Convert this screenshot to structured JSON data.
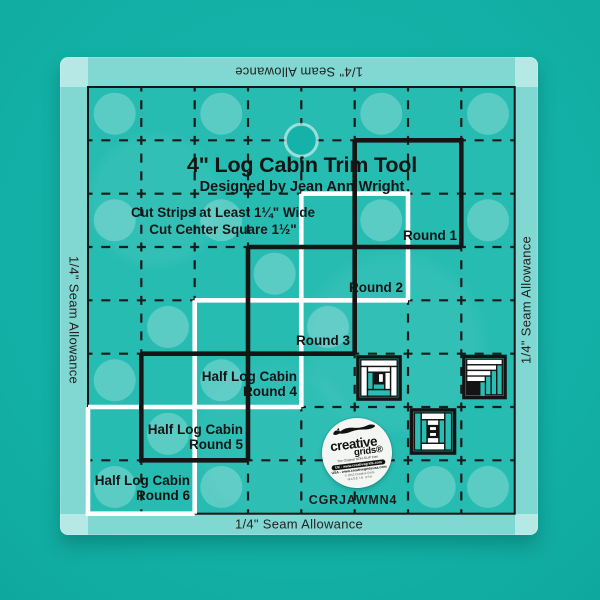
{
  "title": "4\" Log Cabin Trim Tool",
  "subtitle": "Designed by Jean Ann Wright",
  "instructions": {
    "line1": "Cut Strips at Least 1¼\" Wide",
    "line2": "Cut Center Square 1½\""
  },
  "rounds": {
    "r1": "Round 1",
    "r2": "Round 2",
    "r3": "Round 3",
    "half": "Half Log Cabin",
    "r4": "Round 4",
    "r5": "Round 5",
    "r6": "Round 6"
  },
  "seam_allowance": "1/4\" Seam Allowance",
  "sku": "CGRJAWMN4",
  "logo": {
    "brand": "creative",
    "grids": "grids®",
    "tagline": "The Original NON-SLIP from",
    "uk": "UK - www.creativegrids.com",
    "usa": "USA - www.creativegridsusa.com",
    "copyright": "© 2015 Creative Grids",
    "made_in": "MADE IN USA"
  },
  "icons": {
    "block1": "log-cabin-block",
    "block2": "half-log-cabin-block",
    "block3": "courthouse-steps-block"
  },
  "colors": {
    "background": "#14b2a8",
    "ruler_tint": "#27bcb2",
    "grid_line": "#161616",
    "stair_white": "#ffffff",
    "frost": "rgba(255,255,255,0.42)"
  }
}
